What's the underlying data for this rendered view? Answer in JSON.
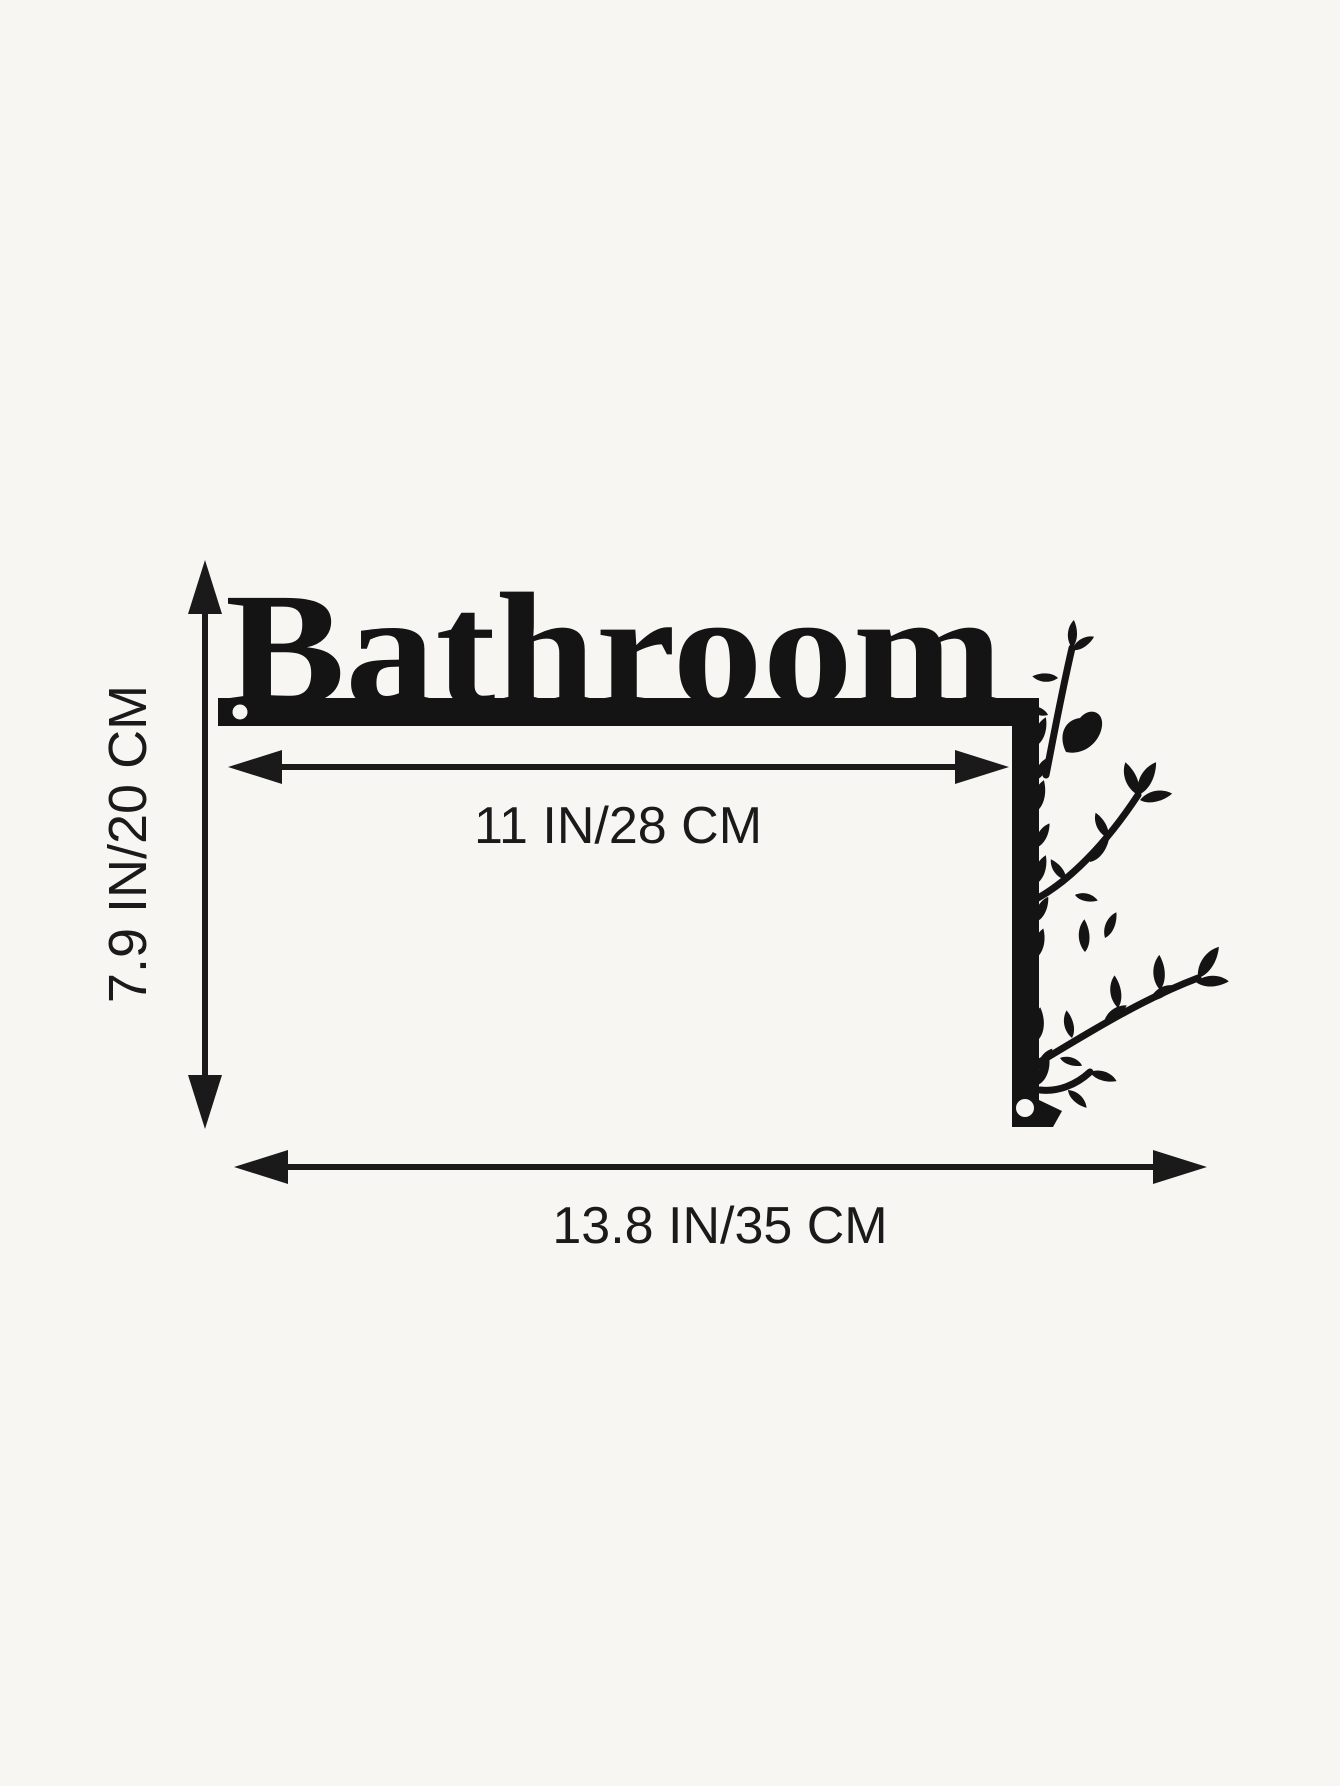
{
  "image": {
    "background": "#f7f6f2",
    "ink": "#141414",
    "dim_ink": "#1a1a1a"
  },
  "sign": {
    "word": "Bathroom",
    "decoration": "floral-branch",
    "mounting_holes": 2
  },
  "dimensions": {
    "inner_width_label": "11 IN/28 CM",
    "height_label": "7.9 IN/20 CM",
    "total_width_label": "13.8 IN/35 CM"
  }
}
